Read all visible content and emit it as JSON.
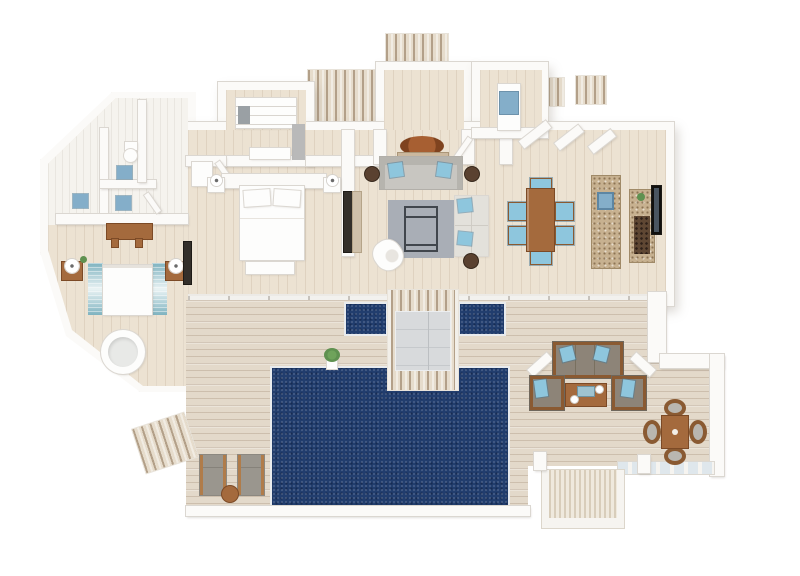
{
  "meta": {
    "title": "Isometric 3D floor plan rendering of a one-bedroom villa with private pool deck",
    "visible_text": "none"
  },
  "colors": {
    "wall": "#fbfaf8",
    "wall_edge": "#dbd7d1",
    "floor": "#ece2d2",
    "deck": "#e3d9ca",
    "stripe_light": "#e6dccc",
    "stripe_dark": "#b3a089",
    "pool": "#213d6e",
    "pool_rim": "#e8ebee",
    "stone": "#c7b190",
    "wood": "#a46a3d",
    "wood_dark": "#7c4a26",
    "blue": "#8ec6dd",
    "blue_fix": "#84aec9",
    "rug_gray": "#a9aeb6",
    "sofa_gray": "#c8c6c1",
    "taupe": "#8d8478",
    "tv": "#332f2a",
    "white_furn": "#fdfdfc",
    "furn_edge": "#dbd7d1",
    "green": "#5f9150",
    "runner_teal": "#7fb3c0",
    "rug_brown": "#9c5a33"
  },
  "scene": {
    "type": "3d-floor-plan",
    "rooms": [
      "bathroom",
      "second-bedroom",
      "walk-in-closet",
      "master-bedroom",
      "entry-hall",
      "utility-room",
      "living-room",
      "dining-area",
      "kitchen",
      "pool-deck"
    ],
    "indoor_furniture": [
      "toilet",
      "double-sinks",
      "shower-mats",
      "wood-console",
      "bed-with-striped-runners",
      "nightstands-with-lamps",
      "round-hot-tub",
      "wall-tv",
      "closet-shelving",
      "closet-bench",
      "master-bed",
      "foot-bench",
      "entry-round-rug",
      "console-table",
      "gray-sofa",
      "l-shaped-sofa",
      "coffee-table",
      "area-rug",
      "white-armchair",
      "round-side-tables",
      "dining-table-6-chairs",
      "kitchen-island-with-sink",
      "stone-counter-wine-rack",
      "kitchen-tv",
      "washer"
    ],
    "outdoor_features": [
      "main-swimming-pool",
      "two-plunge-pools",
      "daybed-island",
      "potted-plant",
      "sun-loungers",
      "round-side-table",
      "outdoor-sofa-set",
      "outdoor-coffee-table",
      "square-dining-table-4-chairs",
      "entry-boardwalk",
      "side-deck-patches",
      "courtyard-deck-strip",
      "steps-ramp",
      "side-walkway",
      "white-parapet-walls"
    ]
  }
}
